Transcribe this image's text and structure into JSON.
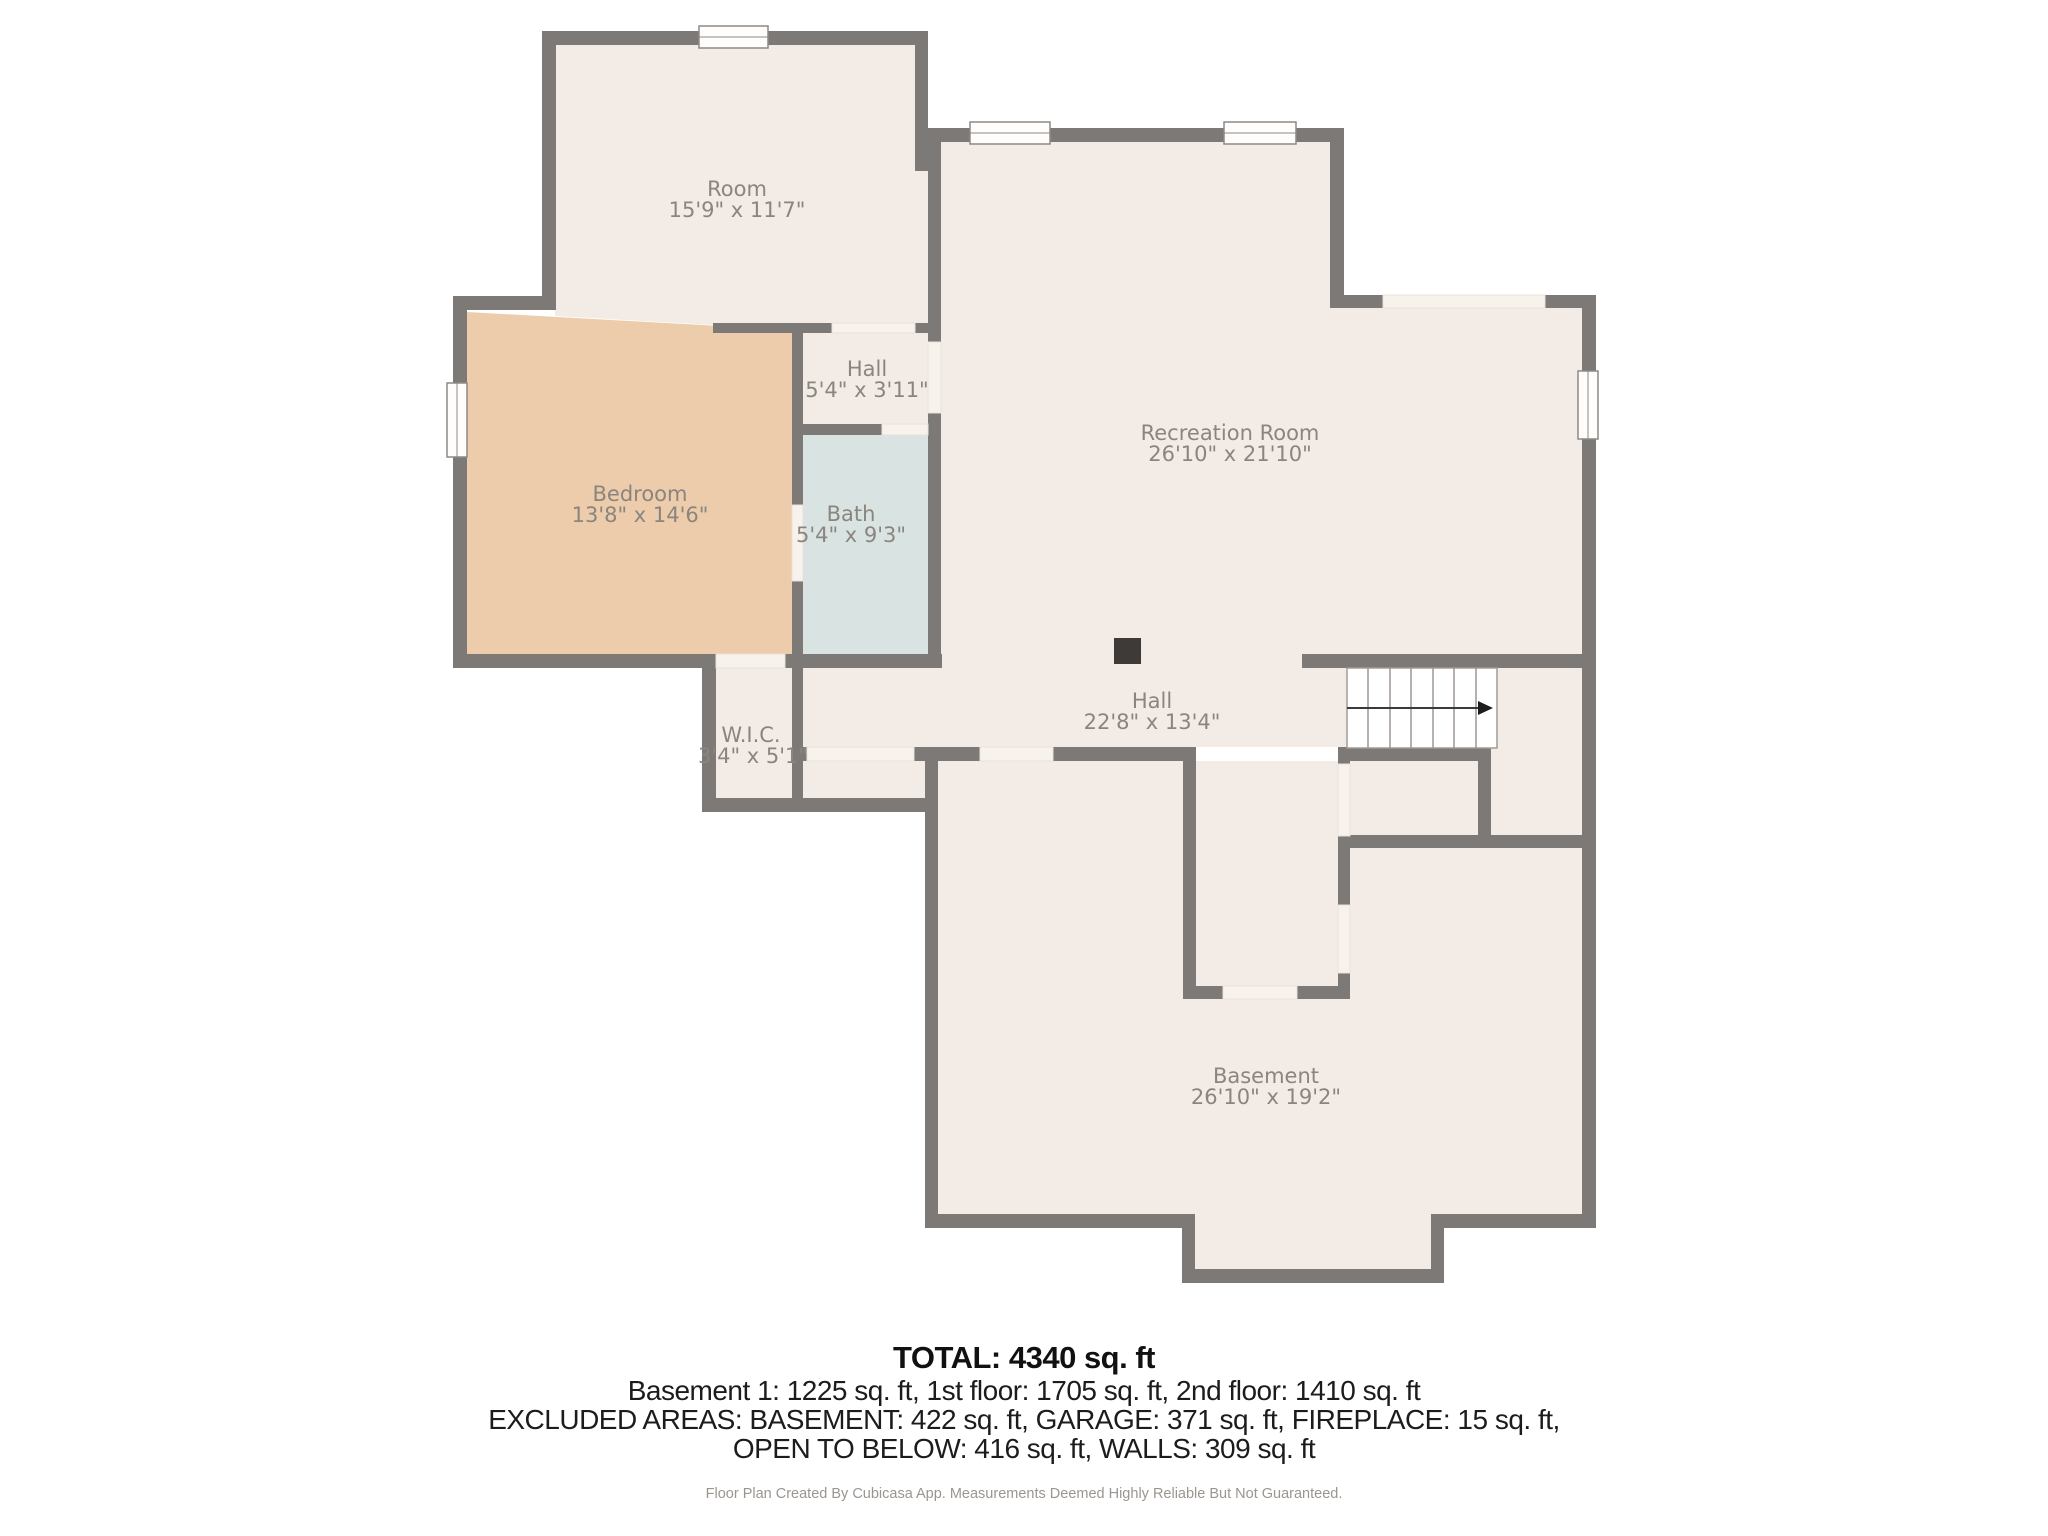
{
  "title": "Basement floor plan",
  "rooms": [
    {
      "id": "room",
      "name": "Room",
      "dims": "15'9\" x 11'7\""
    },
    {
      "id": "hall_upper",
      "name": "Hall",
      "dims": "5'4\" x 3'11\""
    },
    {
      "id": "bedroom",
      "name": "Bedroom",
      "dims": "13'8\" x 14'6\""
    },
    {
      "id": "bath",
      "name": "Bath",
      "dims": "5'4\" x 9'3\""
    },
    {
      "id": "wic",
      "name": "W.I.C.",
      "dims": "3'4\" x 5'1\""
    },
    {
      "id": "recreation",
      "name": "Recreation Room",
      "dims": "26'10\" x 21'10\""
    },
    {
      "id": "hall_lower",
      "name": "Hall",
      "dims": "22'8\" x 13'4\""
    },
    {
      "id": "basement",
      "name": "Basement",
      "dims": "26'10\" x 19'2\""
    }
  ],
  "summary": {
    "total": "TOTAL: 4340 sq. ft",
    "floors": "Basement 1: 1225 sq. ft, 1st floor: 1705 sq. ft, 2nd floor: 1410 sq. ft",
    "excluded_1": "EXCLUDED AREAS: BASEMENT: 422 sq. ft, GARAGE: 371 sq. ft, FIREPLACE: 15 sq. ft,",
    "excluded_2": "OPEN TO BELOW: 416 sq. ft, WALLS: 309 sq. ft"
  },
  "footer": "Floor Plan Created By Cubicasa App. Measurements Deemed Highly Reliable But Not Guaranteed.",
  "colors": {
    "wall": "#7c7976",
    "floor": "#f3ece6",
    "bedroom_floor": "#ecccab",
    "bath_floor": "#d9e4e2",
    "door_gap": "#f7f2ec",
    "label_text": "#8a857f",
    "summary_text": "#111111",
    "footer_text": "#9b9590"
  }
}
